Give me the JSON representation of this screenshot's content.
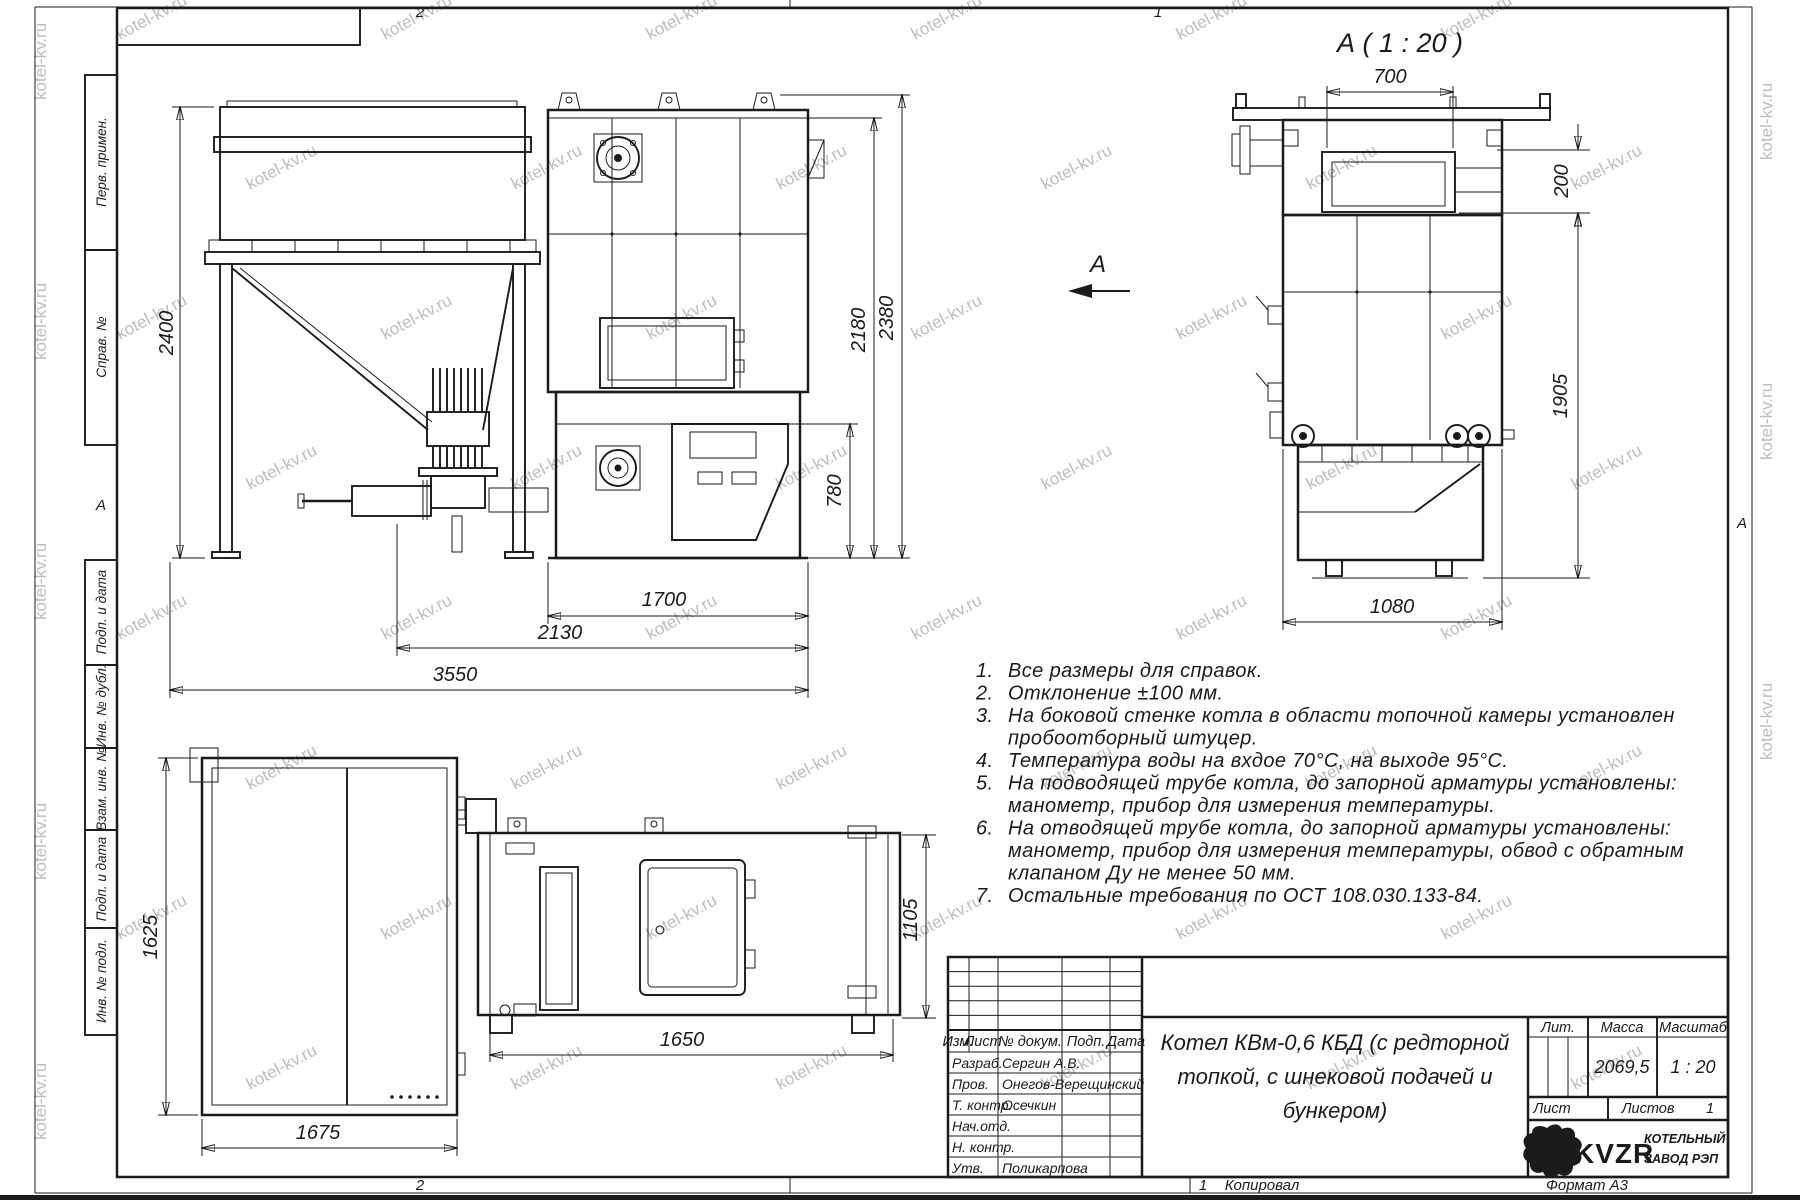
{
  "watermark": {
    "text": "kotel-kv.ru"
  },
  "views": {
    "front": {
      "section_arrow": "А",
      "dims": {
        "bunker_height": "2400",
        "lower_height": "780",
        "body_height": "2180",
        "total_height": "2380",
        "boiler_len": "1700",
        "feed_len": "2130",
        "total_len": "3550"
      }
    },
    "a": {
      "title": "А ( 1 : 20 )",
      "dims": {
        "opening_width": "700",
        "top_offset": "200",
        "height": "1905",
        "width": "1080"
      }
    },
    "plan": {
      "dims": {
        "depth": "1625",
        "width": "1675"
      }
    },
    "side": {
      "dims": {
        "height": "1105",
        "length": "1650"
      }
    }
  },
  "notes": {
    "items": [
      {
        "num": "1.",
        "lines": [
          "Все размеры для справок."
        ]
      },
      {
        "num": "2.",
        "lines": [
          "Отклонение ±100 мм."
        ]
      },
      {
        "num": "3.",
        "lines": [
          "На боковой стенке котла в области топочной камеры установлен",
          "пробоотборный штуцер."
        ]
      },
      {
        "num": "4.",
        "lines": [
          "Температура воды на вхдое 70°С, на выходе 95°С."
        ]
      },
      {
        "num": "5.",
        "lines": [
          "На подводящей трубе котла, до запорной арматуры установлены:",
          "манометр, прибор для измерения температуры."
        ]
      },
      {
        "num": "6.",
        "lines": [
          "На отводящей трубе котла, до запорной арматуры установлены:",
          "манометр, прибор для измерения температуры, обвод с обратным",
          "клапаном Ду не менее 50 мм."
        ]
      },
      {
        "num": "7.",
        "lines": [
          "Остальные требования по ОСТ 108.030.133-84."
        ]
      }
    ]
  },
  "title_block": {
    "rev_header": {
      "izm": "Изм.",
      "list": "Лист",
      "doc": "№ докум.",
      "sign": "Подп.",
      "date": "Дата"
    },
    "rows": [
      {
        "label": "Разраб.",
        "name": "Сергин А.В."
      },
      {
        "label": "Пров.",
        "name": "Онегов-Верещинский"
      },
      {
        "label": "Т. контр.",
        "name": "Осечкин"
      },
      {
        "label": "Нач.отд.",
        "name": ""
      },
      {
        "label": "Н. контр.",
        "name": ""
      },
      {
        "label": "Утв.",
        "name": "Поликарпова"
      }
    ],
    "title_line1": "Котел КВм-0,6 КБД (с редторной",
    "title_line2": "топкой, с шнековой подачей и",
    "title_line3": "бункером)",
    "lit_label": "Лит.",
    "mass_label": "Масса",
    "scale_label": "Масштаб",
    "mass_value": "2069,5",
    "scale_value": "1 : 20",
    "sheet_label": "Лист",
    "sheets_label": "Листов",
    "sheets_value": "1",
    "logo_text": "KVZR",
    "company_line1": "КОТЕЛЬНЫЙ",
    "company_line2": "ЗАВОД РЭП"
  },
  "margins": {
    "left": [
      "Перв. примен.",
      "Справ. №",
      "Подп. и дата",
      "Инв. № дубл.",
      "Взам. инв. №",
      "Подп. и дата",
      "Инв. № подл."
    ],
    "zone_a_left": "А",
    "zone_a_right": "А",
    "top_zone_2": "2",
    "top_zone_1": "1",
    "bottom_zone_2": "2",
    "bottom_sheet_no": "1",
    "copied": "Копировал",
    "format": "Формат А3"
  }
}
